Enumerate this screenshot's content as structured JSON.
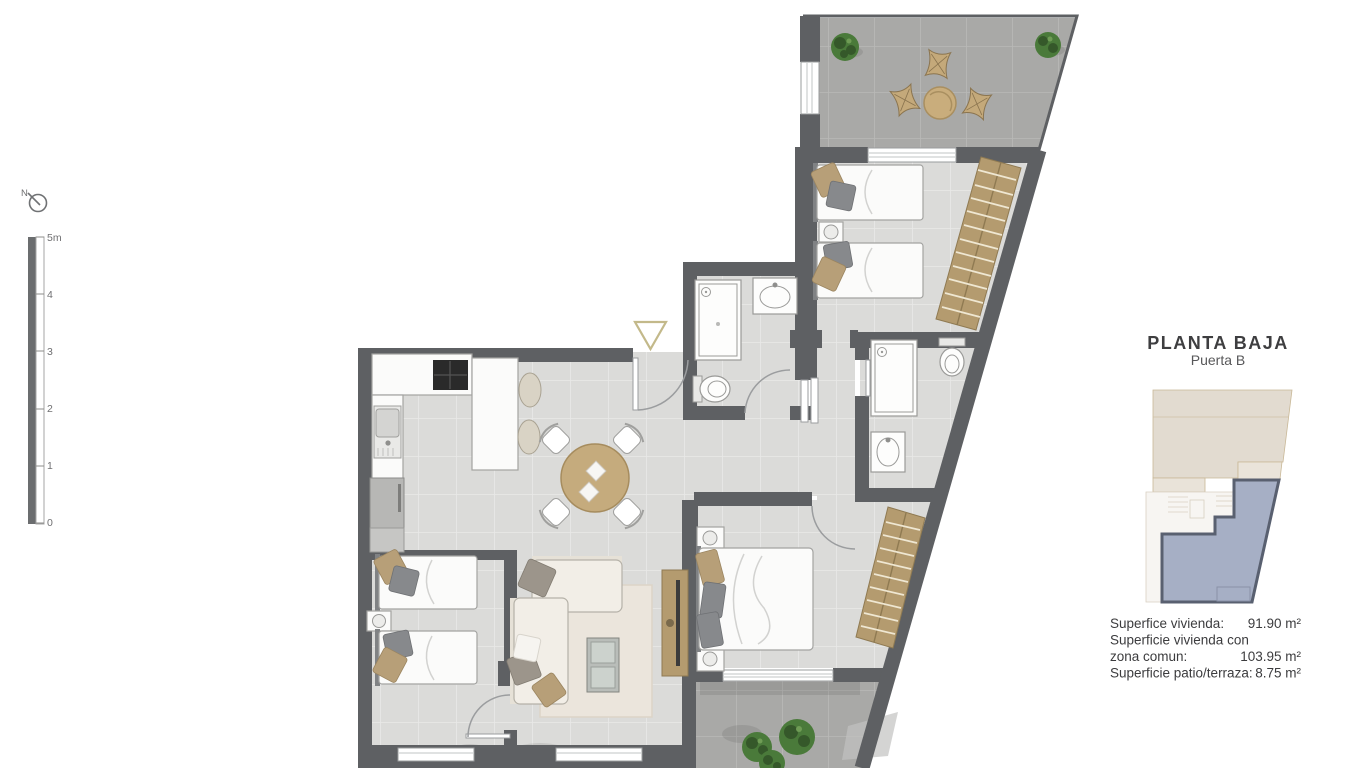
{
  "compass": {
    "label": "N"
  },
  "scale_bar": {
    "unit_labels": [
      "5m",
      "4",
      "3",
      "2",
      "1",
      "0"
    ]
  },
  "panel": {
    "title": "PLANTA BAJA",
    "subtitle": "Puerta B",
    "areas": [
      {
        "label": "Superfice vivienda:",
        "value": "91.90 m²"
      },
      {
        "label": "Superficie vivienda con",
        "label2": "zona comun:",
        "value": "103.95 m²"
      },
      {
        "label": "Superficie patio/terraza:",
        "value": "8.75 m²"
      }
    ]
  },
  "colors": {
    "wall": "#5e6063",
    "wood": "#b49b6f",
    "floor_tile": "#dbdbd9",
    "terrace_tile": "#a9a9a7",
    "plant_green": "#4a7a3a",
    "unit_highlight_fill": "#a6afc5",
    "unit_highlight_stroke": "#596070",
    "keyplan_beige": "#e2dbd0",
    "entrance_marker": "#c3b98a"
  }
}
